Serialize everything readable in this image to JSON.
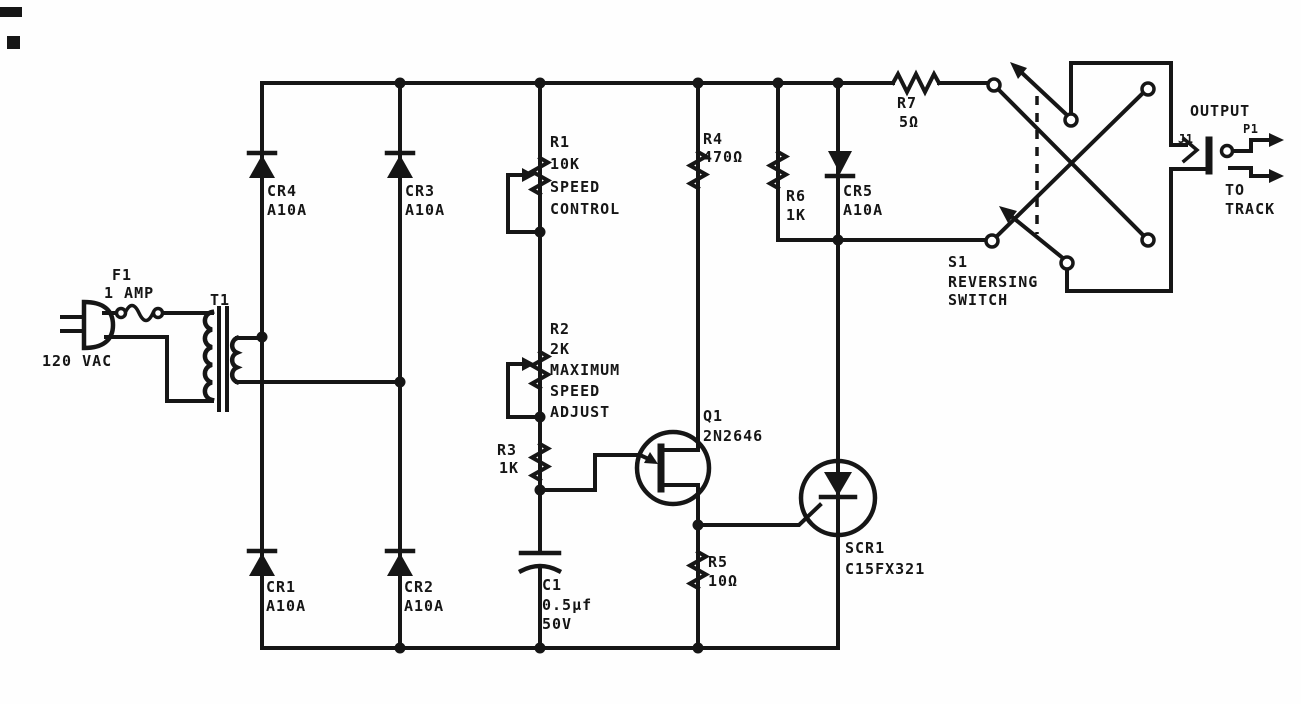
{
  "colors": {
    "ink": "#161616",
    "paper": "#fefefe"
  },
  "components": {
    "source": {
      "label": "120 VAC"
    },
    "f1": {
      "ref": "F1",
      "value": "1 AMP"
    },
    "t1": {
      "ref": "T1"
    },
    "cr1": {
      "ref": "CR1",
      "value": "A10A"
    },
    "cr2": {
      "ref": "CR2",
      "value": "A10A"
    },
    "cr3": {
      "ref": "CR3",
      "value": "A10A"
    },
    "cr4": {
      "ref": "CR4",
      "value": "A10A"
    },
    "cr5": {
      "ref": "CR5",
      "value": "A10A"
    },
    "r1": {
      "ref": "R1",
      "value": "10K",
      "note1": "SPEED",
      "note2": "CONTROL"
    },
    "r2": {
      "ref": "R2",
      "value": "2K",
      "note1": "MAXIMUM",
      "note2": "SPEED",
      "note3": "ADJUST"
    },
    "r3": {
      "ref": "R3",
      "value": "1K"
    },
    "r4": {
      "ref": "R4",
      "value": "470Ω"
    },
    "r5": {
      "ref": "R5",
      "value": "10Ω"
    },
    "r6": {
      "ref": "R6",
      "value": "1K"
    },
    "r7": {
      "ref": "R7",
      "value": "5Ω"
    },
    "c1": {
      "ref": "C1",
      "value": "0.5µf",
      "rating": "50V"
    },
    "q1": {
      "ref": "Q1",
      "value": "2N2646"
    },
    "scr1": {
      "ref": "SCR1",
      "value": "C15FX321"
    },
    "s1": {
      "ref": "S1",
      "note1": "REVERSING",
      "note2": "SWITCH"
    },
    "j1": {
      "ref": "J1"
    },
    "p1": {
      "ref": "P1"
    },
    "output": {
      "label": "OUTPUT",
      "dest1": "TO",
      "dest2": "TRACK"
    }
  }
}
